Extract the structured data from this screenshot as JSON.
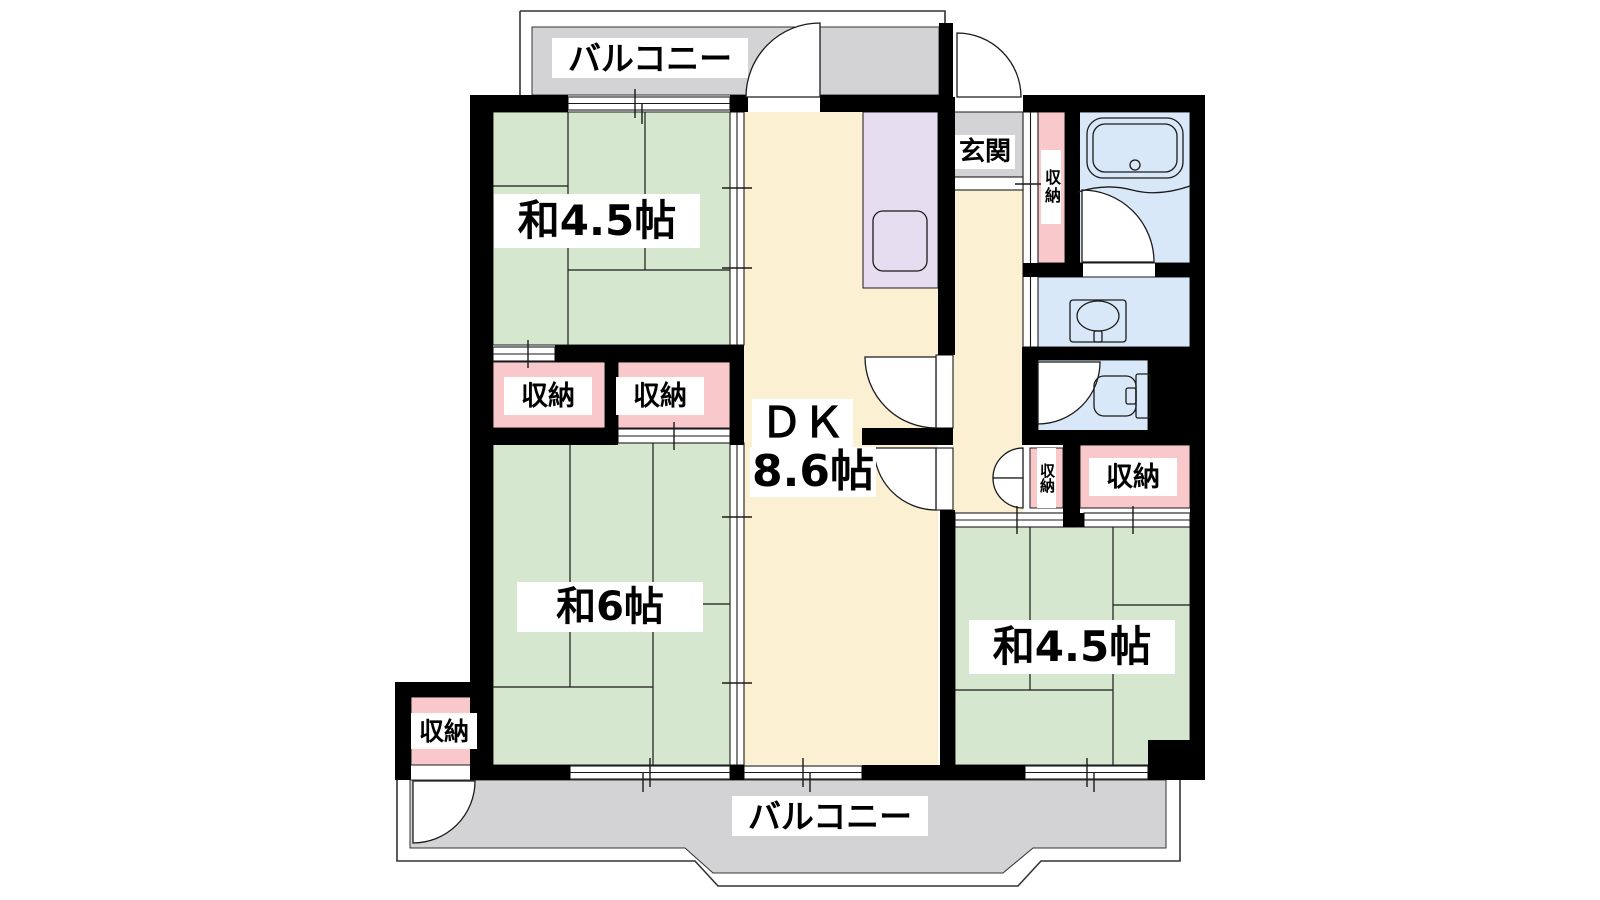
{
  "plan": {
    "title": "apartment-floor-plan",
    "labels": {
      "balcony_top": "バルコニー",
      "balcony_bottom": "バルコニー",
      "room_nw": "和4.5帖",
      "room_sw": "和6帖",
      "room_se": "和4.5帖",
      "dk_name": "ＤＫ",
      "dk_size": "8.6帖",
      "entrance": "玄関",
      "closet_nw_left": "収納",
      "closet_nw_right": "収納",
      "closet_sw": "収納",
      "closet_hall": "収納",
      "closet_se_small": "収納",
      "closet_se_large": "収納"
    },
    "rooms_summary": {
      "tatami_rooms": [
        "和4.5帖",
        "和6帖",
        "和4.5帖"
      ],
      "dining_kitchen": "ＤＫ 8.6帖",
      "balconies": 2,
      "closets": 6
    },
    "colors": {
      "wall": "#000000",
      "tatami_room": "#d5e7cf",
      "dk_floor": "#fbf0d2",
      "kitchen_counter": "#e7ddf1",
      "closet": "#f9c8ca",
      "balcony": "#d3d3d5",
      "entrance_floor": "#d3d3d5",
      "wet_room": "#d9e8f8",
      "line": "#1a1a1a",
      "label_bg": "#ffffff",
      "label_text": "#000000"
    }
  }
}
